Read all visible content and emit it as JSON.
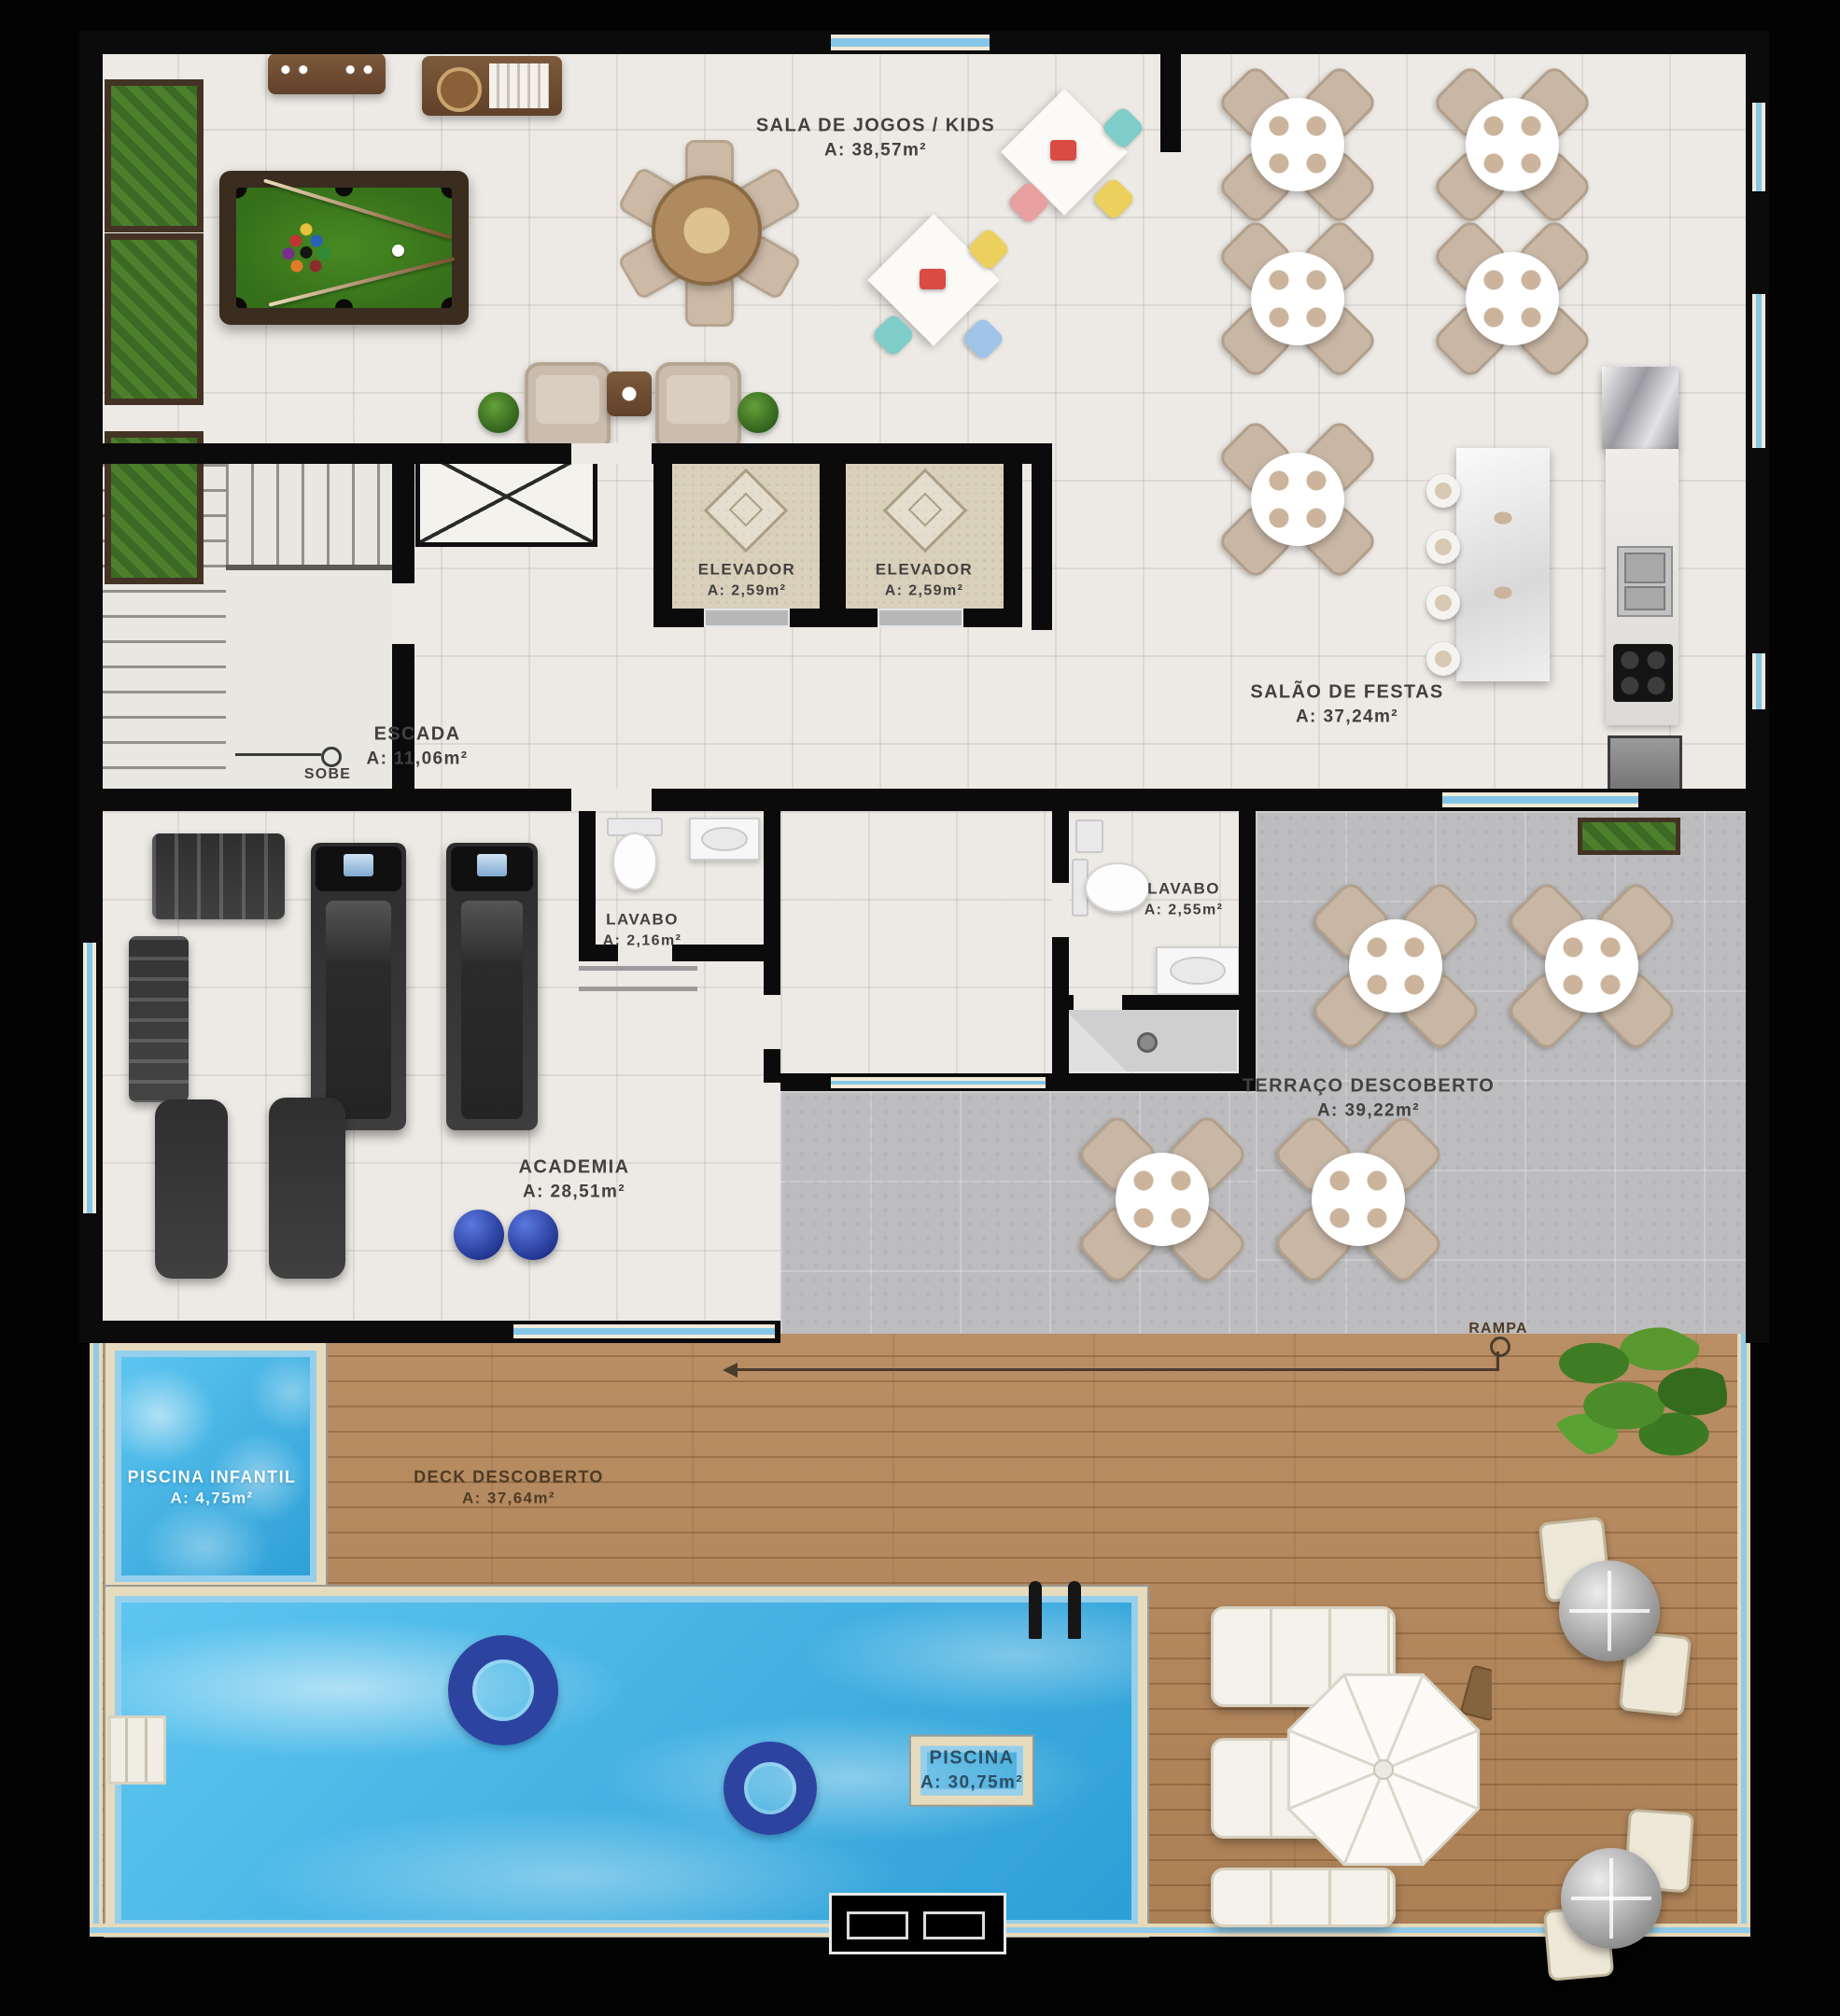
{
  "rooms": {
    "sala_jogos": {
      "name": "SALA DE JOGOS / KIDS",
      "area": "A: 38,57m²"
    },
    "salao_festas": {
      "name": "SALÃO DE FESTAS",
      "area": "A: 37,24m²"
    },
    "elevador_1": {
      "name": "ELEVADOR",
      "area": "A: 2,59m²"
    },
    "elevador_2": {
      "name": "ELEVADOR",
      "area": "A: 2,59m²"
    },
    "escada": {
      "name": "ESCADA",
      "area": "A: 11,06m²"
    },
    "lavabo_1": {
      "name": "LAVABO",
      "area": "A: 2,16m²"
    },
    "lavabo_2": {
      "name": "LAVABO",
      "area": "A: 2,55m²"
    },
    "academia": {
      "name": "ACADEMIA",
      "area": "A: 28,51m²"
    },
    "terraco": {
      "name": "TERRAÇO DESCOBERTO",
      "area": "A: 39,22m²"
    },
    "piscina_infantil": {
      "name": "PISCINA INFANTIL",
      "area": "A: 4,75m²"
    },
    "deck": {
      "name": "DECK DESCOBERTO",
      "area": "A: 37,64m²"
    },
    "piscina": {
      "name": "PISCINA",
      "area": "A: 30,75m²"
    }
  },
  "markers": {
    "sobe": "SOBE",
    "rampa": "RAMPA"
  },
  "colors": {
    "wall": "#0b0b0b",
    "tile_floor": "#edeae5",
    "concrete_floor": "#bdbdbf",
    "wood_deck": "#b5875a",
    "pool_water": "#45b5e9",
    "billiard_felt": "#3e7c1c",
    "label_text": "#42413f"
  }
}
